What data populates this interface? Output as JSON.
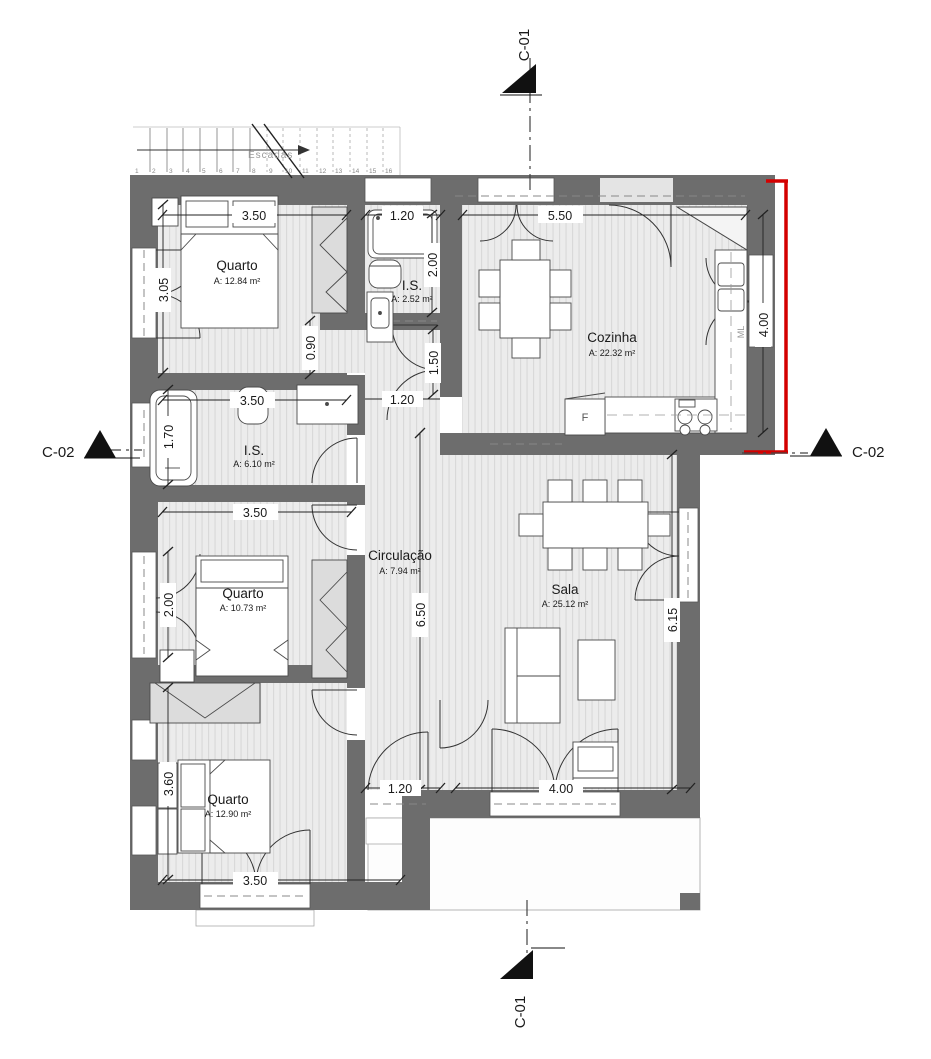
{
  "drawing_type": "architectural floor plan",
  "colors": {
    "wall": "#6d6d6d",
    "floor": "#ececec",
    "floor_line": "#d9d9d9",
    "accent_red": "#d40000",
    "furniture_stroke": "#4a4a4a"
  },
  "sections": {
    "c01_top": "C-01",
    "c01_bottom": "C-01",
    "c02_left": "C-02",
    "c02_right": "C-02"
  },
  "stairs": {
    "label": "Escadas",
    "numbers": [
      "1",
      "2",
      "3",
      "4",
      "5",
      "6",
      "7",
      "8",
      "9",
      "10",
      "11",
      "12",
      "13",
      "14",
      "15",
      "16"
    ]
  },
  "rooms": {
    "quarto1": {
      "name": "Quarto",
      "area": "A: 12.84 m²"
    },
    "is1": {
      "name": "I.S.",
      "area": "A: 2.52 m²"
    },
    "cozinha": {
      "name": "Cozinha",
      "area": "A: 22.32 m²"
    },
    "is2": {
      "name": "I.S.",
      "area": "A: 6.10 m²"
    },
    "quarto2": {
      "name": "Quarto",
      "area": "A: 10.73 m²"
    },
    "circulacao": {
      "name": "Circulação",
      "area": "A: 7.94 m²"
    },
    "sala": {
      "name": "Sala",
      "area": "A: 25.12 m²"
    },
    "quarto3": {
      "name": "Quarto",
      "area": "A: 12.90 m²"
    }
  },
  "appliances": {
    "fridge": "F",
    "washer": "ML"
  },
  "dims": {
    "quarto1_w": "3.50",
    "is1_w": "1.20",
    "cozinha_w": "5.50",
    "is1_h": "2.00",
    "quarto1_left": "3.05",
    "hall_top": "0.90",
    "hall_mid": "1.50",
    "kitchen_door": "1.20",
    "cozinha_right": "4.00",
    "is2_w": "3.50",
    "is2_left": "1.70",
    "quarto2_w": "3.50",
    "quarto2_left": "2.00",
    "circulacao_h": "6.50",
    "sala_right": "6.15",
    "quarto3_left": "3.60",
    "circulacao_door": "1.20",
    "sala_w": "4.00",
    "quarto3_w": "3.50"
  }
}
